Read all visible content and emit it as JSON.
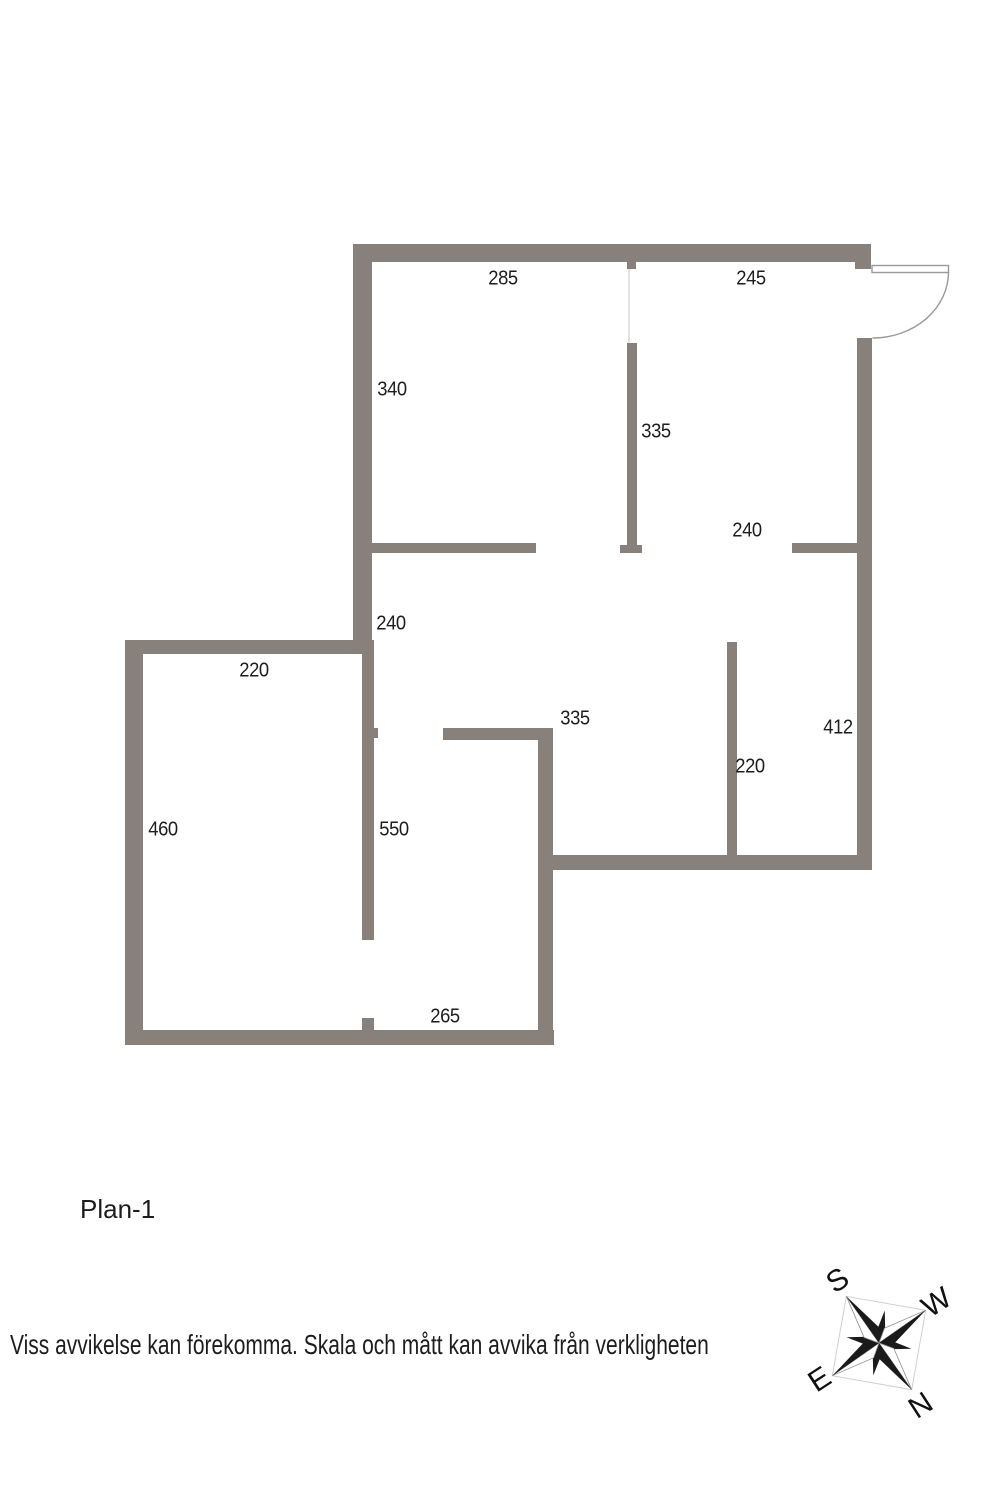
{
  "floorplan": {
    "title": "Plan-1",
    "disclaimer": "Viss avvikelse kan förekomma. Skala och mått kan avvika från verkligheten",
    "measurements": [
      {
        "value": "285",
        "location": "top-left-room-width"
      },
      {
        "value": "245",
        "location": "top-right-room-width"
      },
      {
        "value": "340",
        "location": "upper-left-room-height"
      },
      {
        "value": "335",
        "location": "upper-middle-partition"
      },
      {
        "value": "240",
        "location": "right-partition-width"
      },
      {
        "value": "240",
        "location": "left-corridor-height"
      },
      {
        "value": "220",
        "location": "left-room-width"
      },
      {
        "value": "335",
        "location": "lower-middle-partition"
      },
      {
        "value": "412",
        "location": "right-room-height"
      },
      {
        "value": "220",
        "location": "lower-right-partition"
      },
      {
        "value": "460",
        "location": "left-room-height"
      },
      {
        "value": "550",
        "location": "left-partition-height"
      },
      {
        "value": "265",
        "location": "bottom-wall-width"
      }
    ],
    "compass": {
      "s": "S",
      "w": "W",
      "e": "E",
      "n": "N"
    },
    "colors": {
      "wall": "#87807b",
      "text": "#1d1d1d",
      "door": "#9a9a9a",
      "compass": "#1a1a1a",
      "guide": "#e4e2df"
    }
  }
}
